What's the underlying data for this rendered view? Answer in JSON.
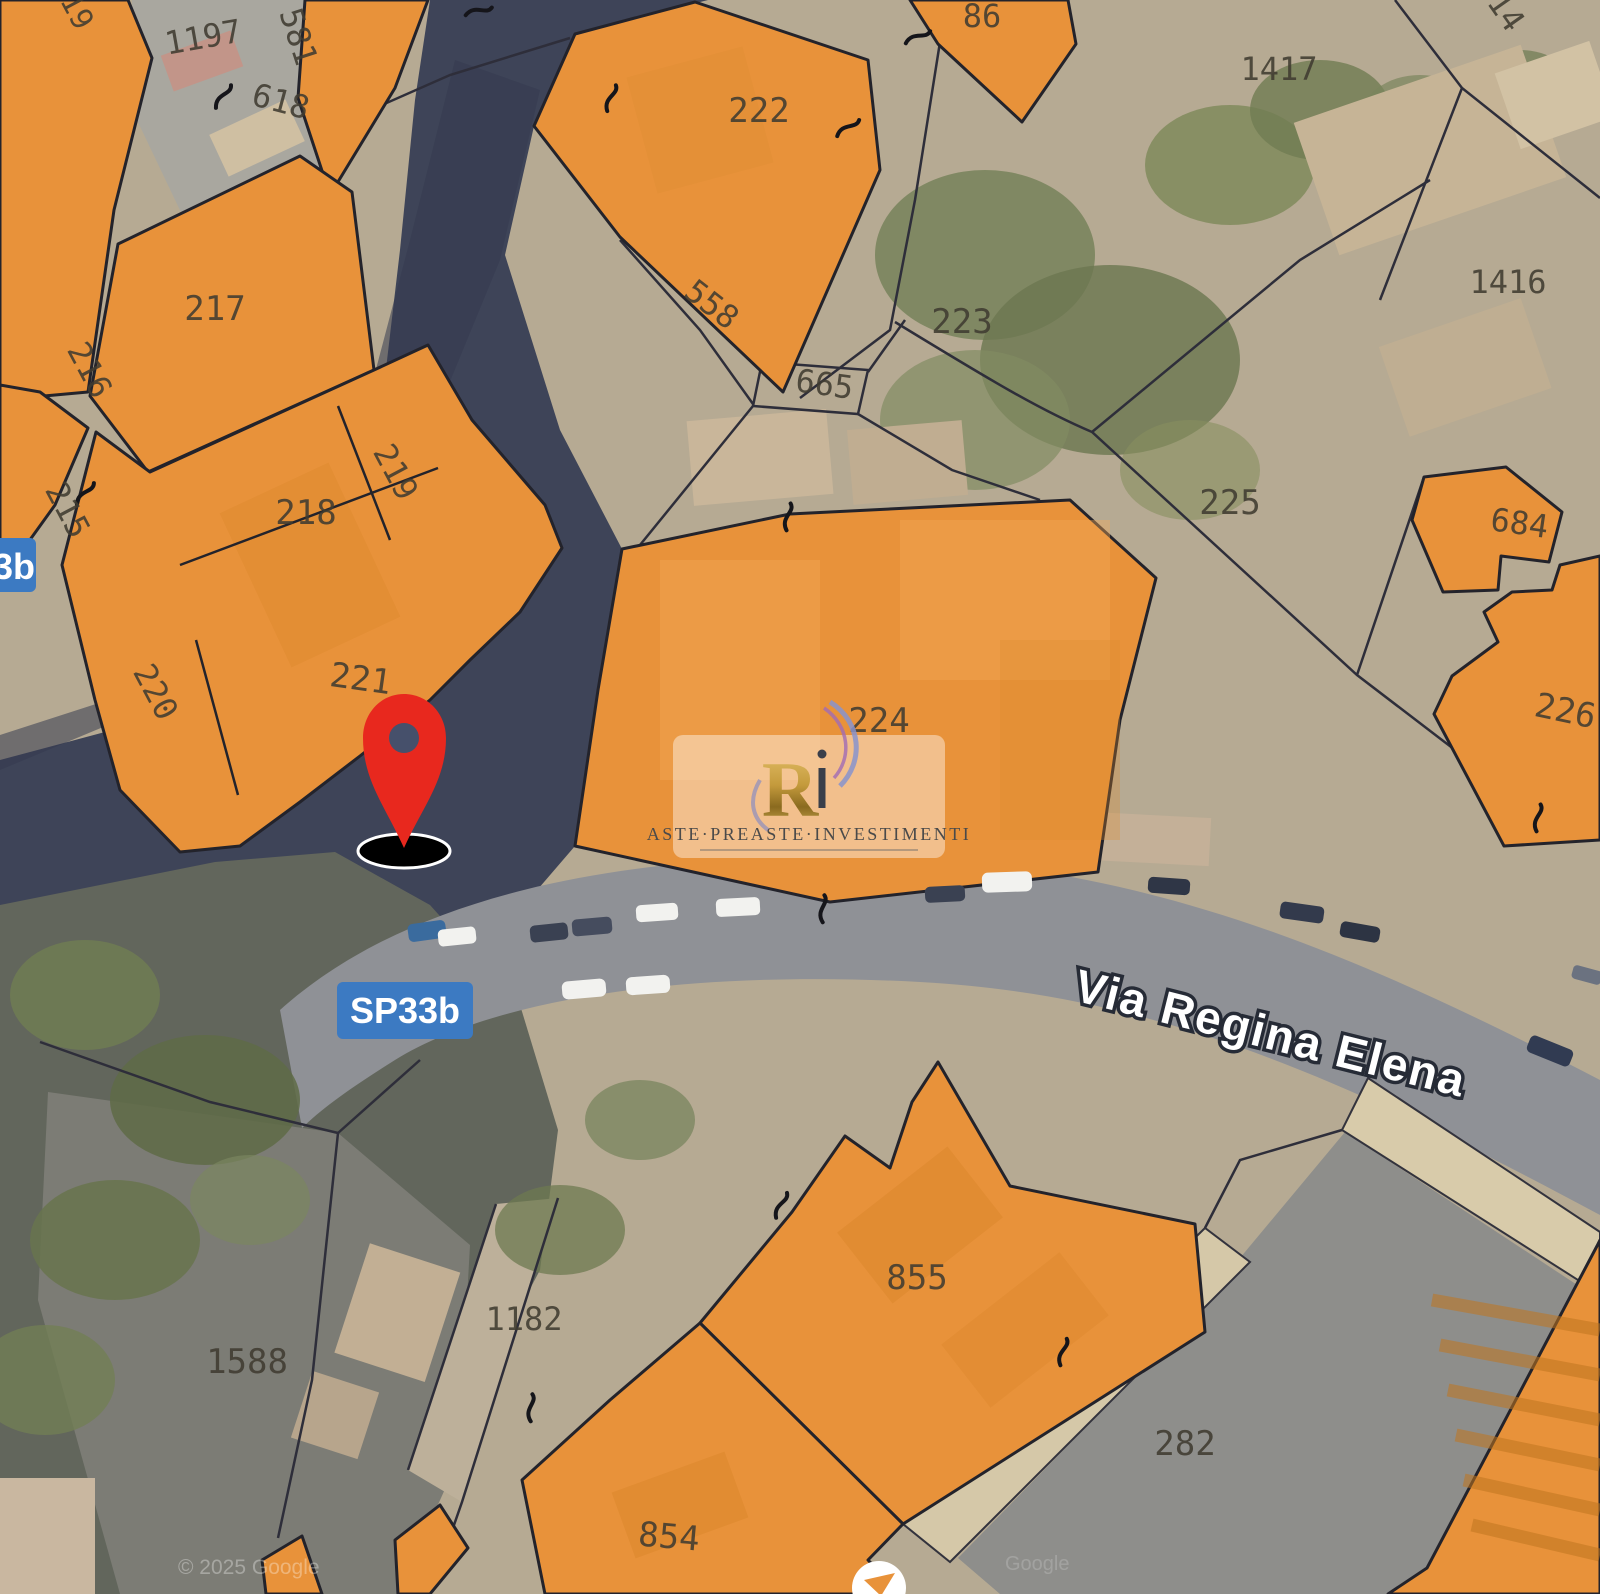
{
  "map": {
    "street": {
      "name": "Via Regina Elena"
    },
    "route_badge": {
      "label": "SP33b"
    },
    "route_badge_left": {
      "label": "3b"
    },
    "watermark": {
      "monogram": "R",
      "brand": "ASTE·PREASTE·INVESTIMENTI"
    },
    "attribution": {
      "line1": "© 2025 Google",
      "line2": "Google"
    },
    "colors": {
      "parcel_orange": "#e8923a",
      "badge_blue": "#3c7ac2",
      "pin_red": "#e8281e",
      "road_dark": "#3e4458",
      "road_gray": "#8f9196"
    }
  },
  "parcels": [
    {
      "label": "19"
    },
    {
      "label": "1197"
    },
    {
      "label": "581"
    },
    {
      "label": "618"
    },
    {
      "label": "86"
    },
    {
      "label": "222"
    },
    {
      "label": "1417"
    },
    {
      "label": "14"
    },
    {
      "label": "217"
    },
    {
      "label": "216"
    },
    {
      "label": "558"
    },
    {
      "label": "665"
    },
    {
      "label": "223"
    },
    {
      "label": "215"
    },
    {
      "label": "218"
    },
    {
      "label": "219"
    },
    {
      "label": "225"
    },
    {
      "label": "684"
    },
    {
      "label": "220"
    },
    {
      "label": "221"
    },
    {
      "label": "224"
    },
    {
      "label": "226"
    },
    {
      "label": "1416"
    },
    {
      "label": "855"
    },
    {
      "label": "1182"
    },
    {
      "label": "1588"
    },
    {
      "label": "282"
    },
    {
      "label": "854"
    }
  ]
}
